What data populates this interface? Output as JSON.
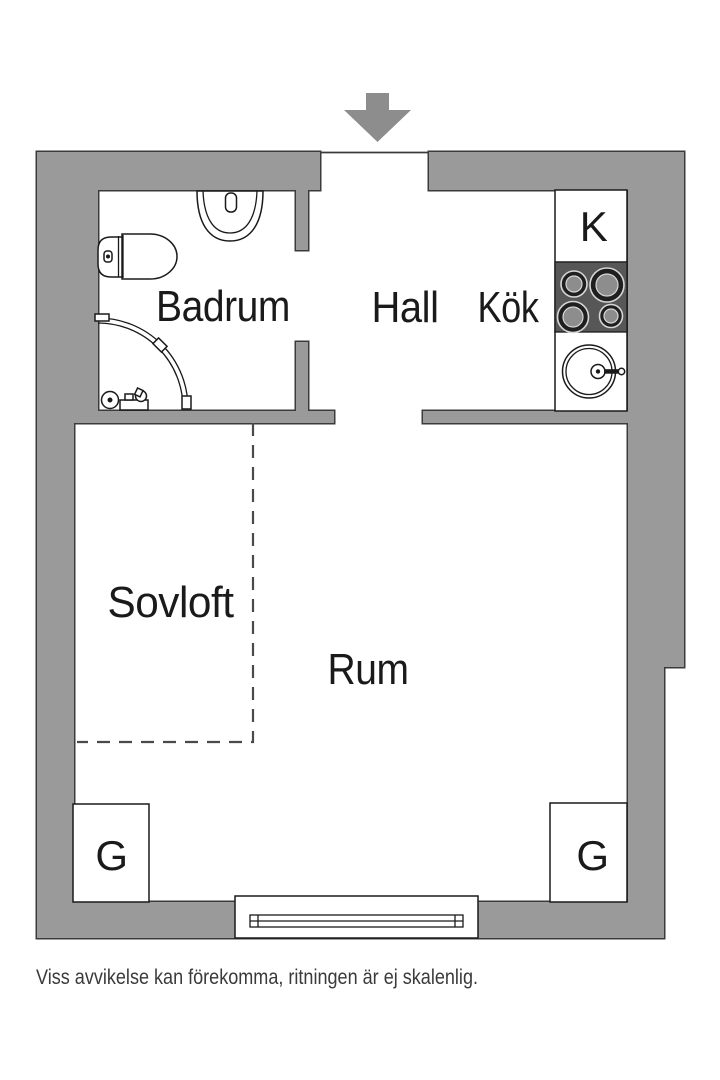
{
  "colors": {
    "background": "#ffffff",
    "wall_fill": "#9a9a9a",
    "wall_outline": "#3b3b3b",
    "arrow": "#8d8d8d",
    "stove_fill": "#575757",
    "burner_ring": "#d6d6d6",
    "burner_dark": "#1f1f1f",
    "burner_disc": "#8d8d8d",
    "fixture_stroke": "#1a1a1a",
    "dash_line": "#4a4a4a",
    "label_text": "#1a1a1a",
    "caption_text": "#3a3a3a"
  },
  "rooms": {
    "badrum": "Badrum",
    "hall": "Hall",
    "kok": "Kök",
    "fridge": "K",
    "sovloft": "Sovloft",
    "rum": "Rum",
    "wardrobe_left": "G",
    "wardrobe_right": "G"
  },
  "caption": "Viss avvikelse kan förekomma, ritningen är ej skalenlig.",
  "icons": {
    "entrance_arrow": "entrance-direction-arrow",
    "toilet": "toilet",
    "washbasin": "washbasin",
    "shower": "corner-shower",
    "floor_drain": "floor-drain",
    "stove": "stove-4-burners",
    "kitchen_sink": "round-kitchen-sink",
    "window": "window"
  }
}
